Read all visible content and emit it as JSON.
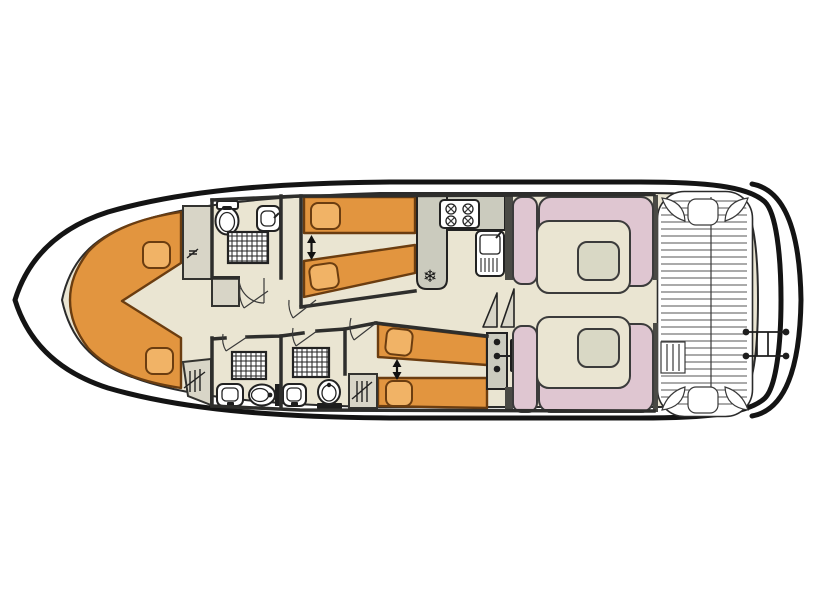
{
  "colors": {
    "interior": "#EAE5D2",
    "bed": "#E2953F",
    "pillow": "#F1B366",
    "seat_pink": "#DFC6D1",
    "table": "#D9D8C5",
    "counter": "#CBCBBE",
    "cabinet": "#D8D5C7",
    "dark_wall": "#4A4A45",
    "hull_outline": "#141414",
    "deck_plank": "#555555"
  },
  "icons": {
    "fridge": "❄"
  }
}
